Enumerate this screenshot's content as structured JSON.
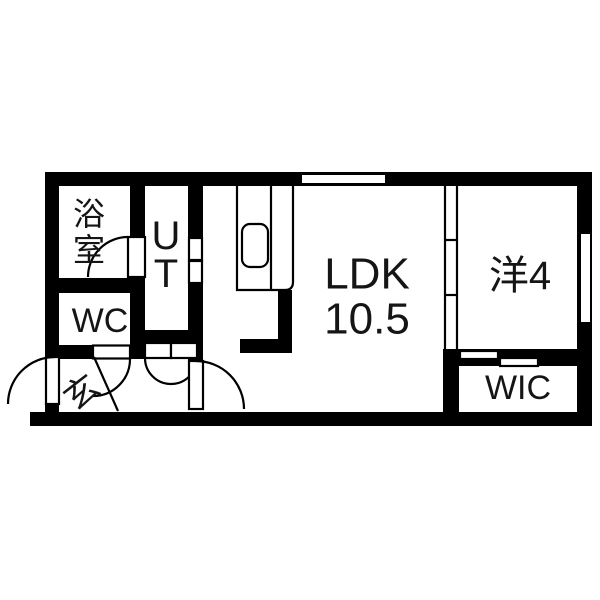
{
  "plan": {
    "type": "floorplan",
    "colors": {
      "wall": "#000000",
      "background": "#ffffff",
      "text": "#151515"
    },
    "rooms": {
      "bathroom": {
        "label": "浴室",
        "chars": [
          "浴",
          "室"
        ],
        "orientation": "vertical"
      },
      "utility": {
        "label": "UT",
        "chars": [
          "U",
          "T"
        ],
        "orientation": "vertical"
      },
      "wc": {
        "label": "WC"
      },
      "entrance": {
        "label": "玄"
      },
      "ldk": {
        "label": "LDK",
        "area": "10.5"
      },
      "western": {
        "label": "洋4"
      },
      "wic": {
        "label": "WIC"
      }
    },
    "features": [
      "top-window",
      "right-window",
      "entrance-swing-door",
      "bathroom-swing-door",
      "wc-swing-door",
      "ldk-swing-door",
      "utility-folding-door",
      "hall-double-doors",
      "sliding-partition-3-panel",
      "wic-sliding-door",
      "kitchen-counter",
      "kitchen-sink",
      "entrance-step-line"
    ]
  }
}
